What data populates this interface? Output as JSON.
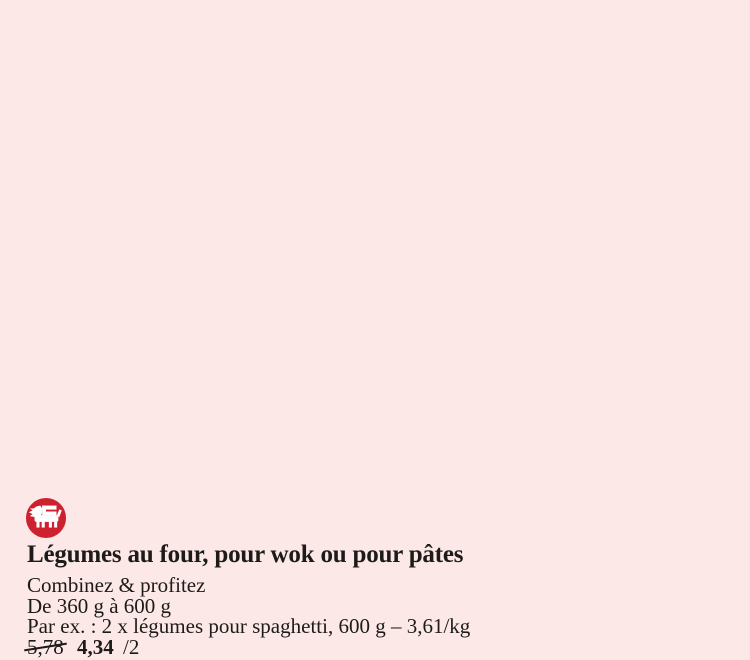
{
  "page": {
    "background_color": "#fce8e6",
    "text_color": "#1c1b19"
  },
  "brand": {
    "name": "Delhaize",
    "logo_icon": "delhaize-lion-icon",
    "logo_color": "#ce2130",
    "logo_glyph_color": "#ffffff"
  },
  "product": {
    "title": "Légumes au four, pour wok ou pour pâtes",
    "promo_line": "Combinez & profitez",
    "weight_line": "De 360 g à 600 g",
    "example_line": "Par ex. : 2 x légumes pour spaghetti, 600 g – 3,61/kg",
    "price": {
      "old": "5,78",
      "new": "4,34",
      "unit": "/2"
    }
  }
}
